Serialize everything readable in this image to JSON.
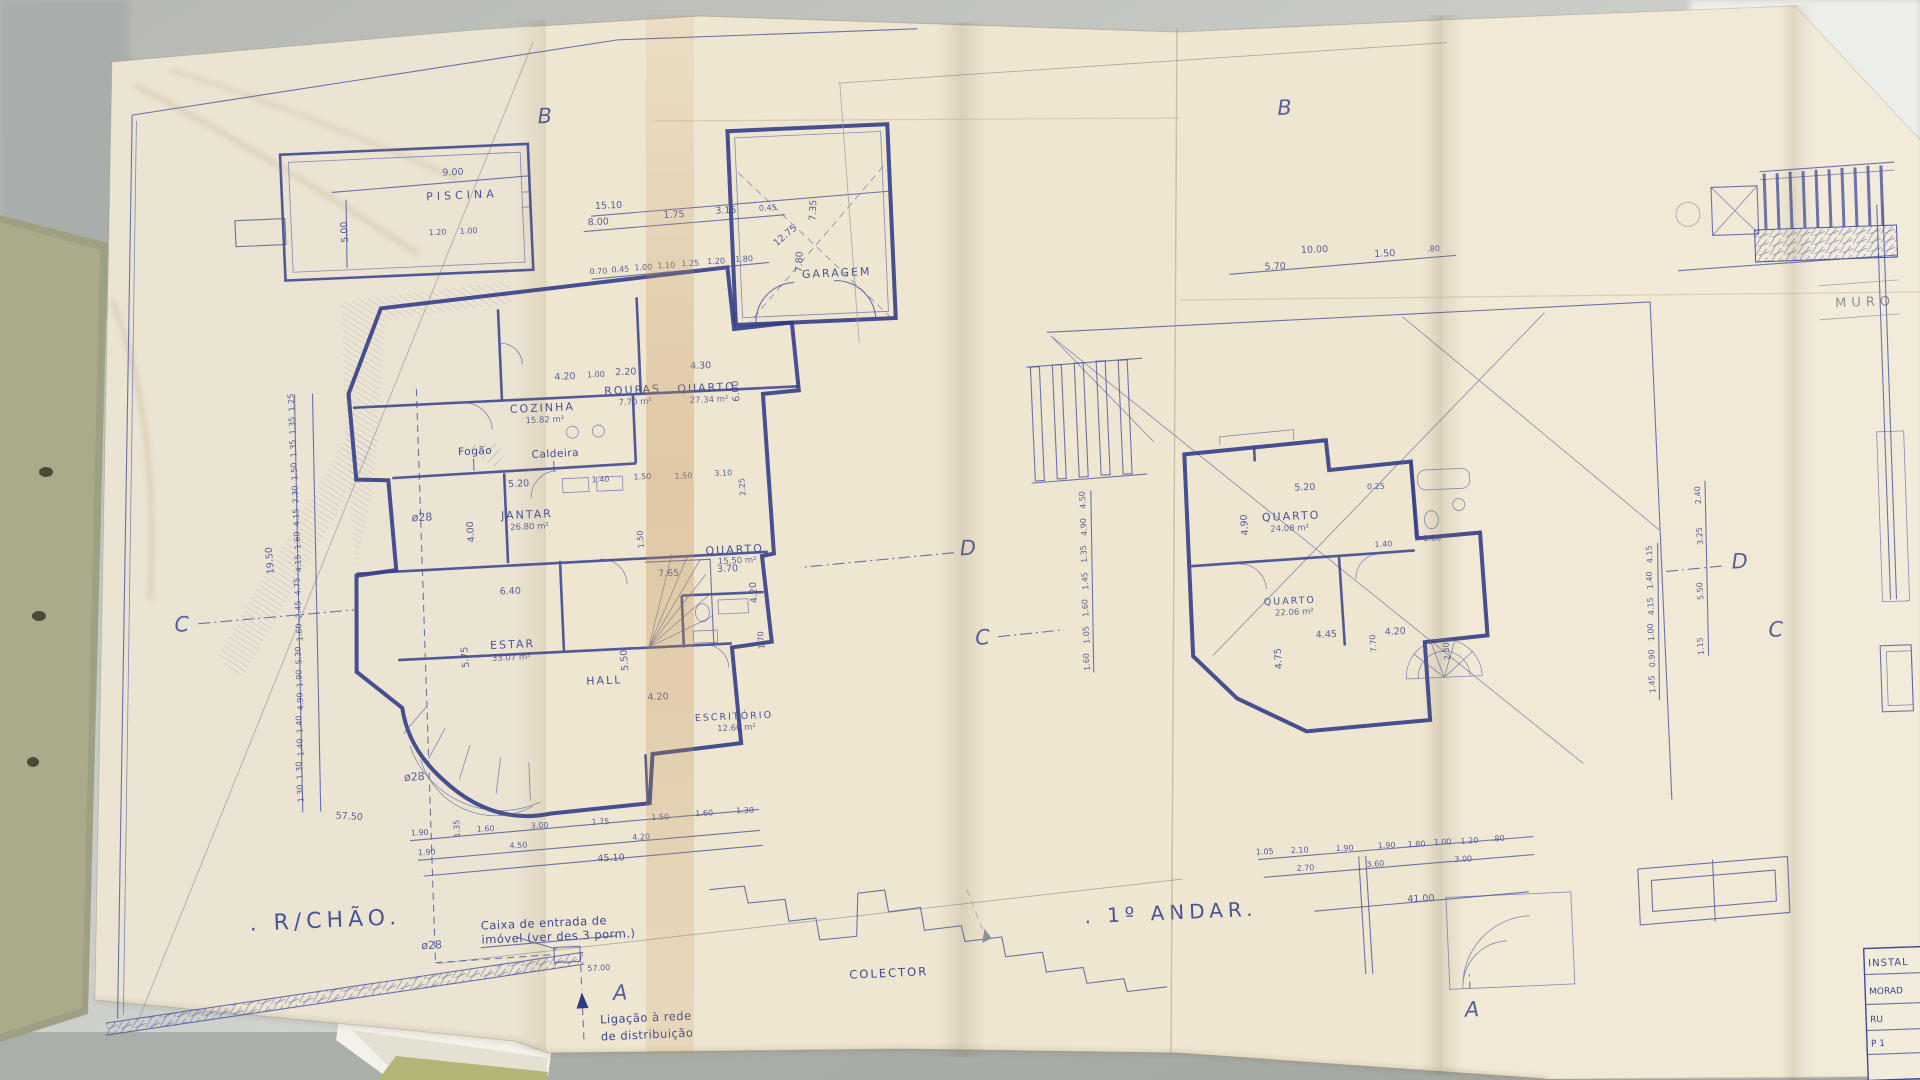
{
  "photo_surface": {
    "desk_color": "#c9ccc7",
    "paper_color": "#efe6d1",
    "ink_color": "#3f4b9b",
    "stain_color": "#c08f4f",
    "folder_color": "#9fa083"
  },
  "sheet_left": {
    "title": ". R/CHÃO.",
    "rooms": [
      {
        "name": "PISCINA",
        "area": ""
      },
      {
        "name": "GARAGEM",
        "area": ""
      },
      {
        "name": "COZINHA",
        "area": "15.82 m²"
      },
      {
        "name": "ROUPAS",
        "area": "7.70 m²"
      },
      {
        "name": "QUARTO",
        "area": "27.34 m²"
      },
      {
        "name": "JANTAR",
        "area": "26.80 m²"
      },
      {
        "name": "ESTAR",
        "area": "33.07 m²"
      },
      {
        "name": "HALL",
        "area": ""
      },
      {
        "name": "QUARTO",
        "area": "15.50 m²"
      },
      {
        "name": "ESCRITÓRIO",
        "area": "12.60 m²"
      }
    ],
    "equipment": [
      "Fogão",
      "Caldeira"
    ],
    "pipes": [
      "ø28",
      "ø28",
      "ø28"
    ],
    "notes": {
      "caixa_1": "Caixa de entrada de",
      "caixa_2": "imóvel (ver des 3 porm.)",
      "ligacao_1": "Ligação à rede",
      "ligacao_2": "de distribuição",
      "colector": "COLECTOR"
    },
    "markers": [
      "B",
      "C",
      "D",
      "A"
    ],
    "dims": [
      "9.00",
      "5.00",
      "1.20",
      "1.00",
      "15.10",
      "8.00",
      "1.75",
      "3.15",
      "0.45",
      "0.70",
      "0.45",
      "1.00",
      "1.10",
      "1.25",
      "1.20",
      "1.80",
      "12.75",
      "7.35",
      "7.80",
      "4.20",
      "1.00",
      "2.20",
      "4.30",
      "6.00",
      "5.20",
      "4.00",
      "1.40",
      "1.50",
      "1.50",
      "3.10",
      "2.25",
      "1.50",
      "7.65",
      "3.70",
      "4.20",
      "1.70",
      "5.75",
      "5.50",
      "6.40",
      "4.20",
      "57.50",
      "45.10",
      "1.90",
      "1.35",
      "1.60",
      "3.00",
      "1.75",
      "1.50",
      "1.60",
      "1.30",
      "1.90",
      "4.50",
      "4.20",
      "19.50",
      "1.25",
      "1.35",
      "1.35",
      "1.50",
      "2.30",
      "4.15",
      "1.60",
      "4.15",
      "4.75",
      "2.45",
      "1.60",
      "5.30",
      "1.90",
      "4.90",
      "1.40",
      "1.40",
      "1.30",
      "1.30",
      "57.00"
    ]
  },
  "sheet_right": {
    "title": ". 1º ANDAR.",
    "rooms": [
      {
        "name": "QUARTO",
        "area": "24.08 m²"
      },
      {
        "name": "QUARTO",
        "area": "22.06 m²"
      }
    ],
    "markers": [
      "B",
      "C",
      "D",
      "A"
    ],
    "dims": [
      "5.70",
      "10.00",
      "1.50",
      ".80",
      "5.20",
      "0.25",
      "4.90",
      "1.40",
      "1.86",
      "4.45",
      "4.20",
      "4.75",
      "7.70",
      "2.30",
      "4.50",
      "4.90",
      "1.35",
      "1.45",
      "1.60",
      "1.05",
      "1.60",
      "4.15",
      "1.40",
      "4.15",
      "1.00",
      "0.90",
      "1.45",
      "2.40",
      "3.25",
      "5.50",
      "1.15",
      "1.05",
      "2.10",
      "1.90",
      "1.90",
      "1.80",
      "1.00",
      "1.20",
      ".80",
      "2.70",
      "3.60",
      "3.00",
      "41.00"
    ]
  },
  "margin_right": {
    "pencil_label": "MURO",
    "marker": "C",
    "table_rows": [
      "INSTAL",
      "MORAD",
      "RU",
      "P 1"
    ]
  }
}
